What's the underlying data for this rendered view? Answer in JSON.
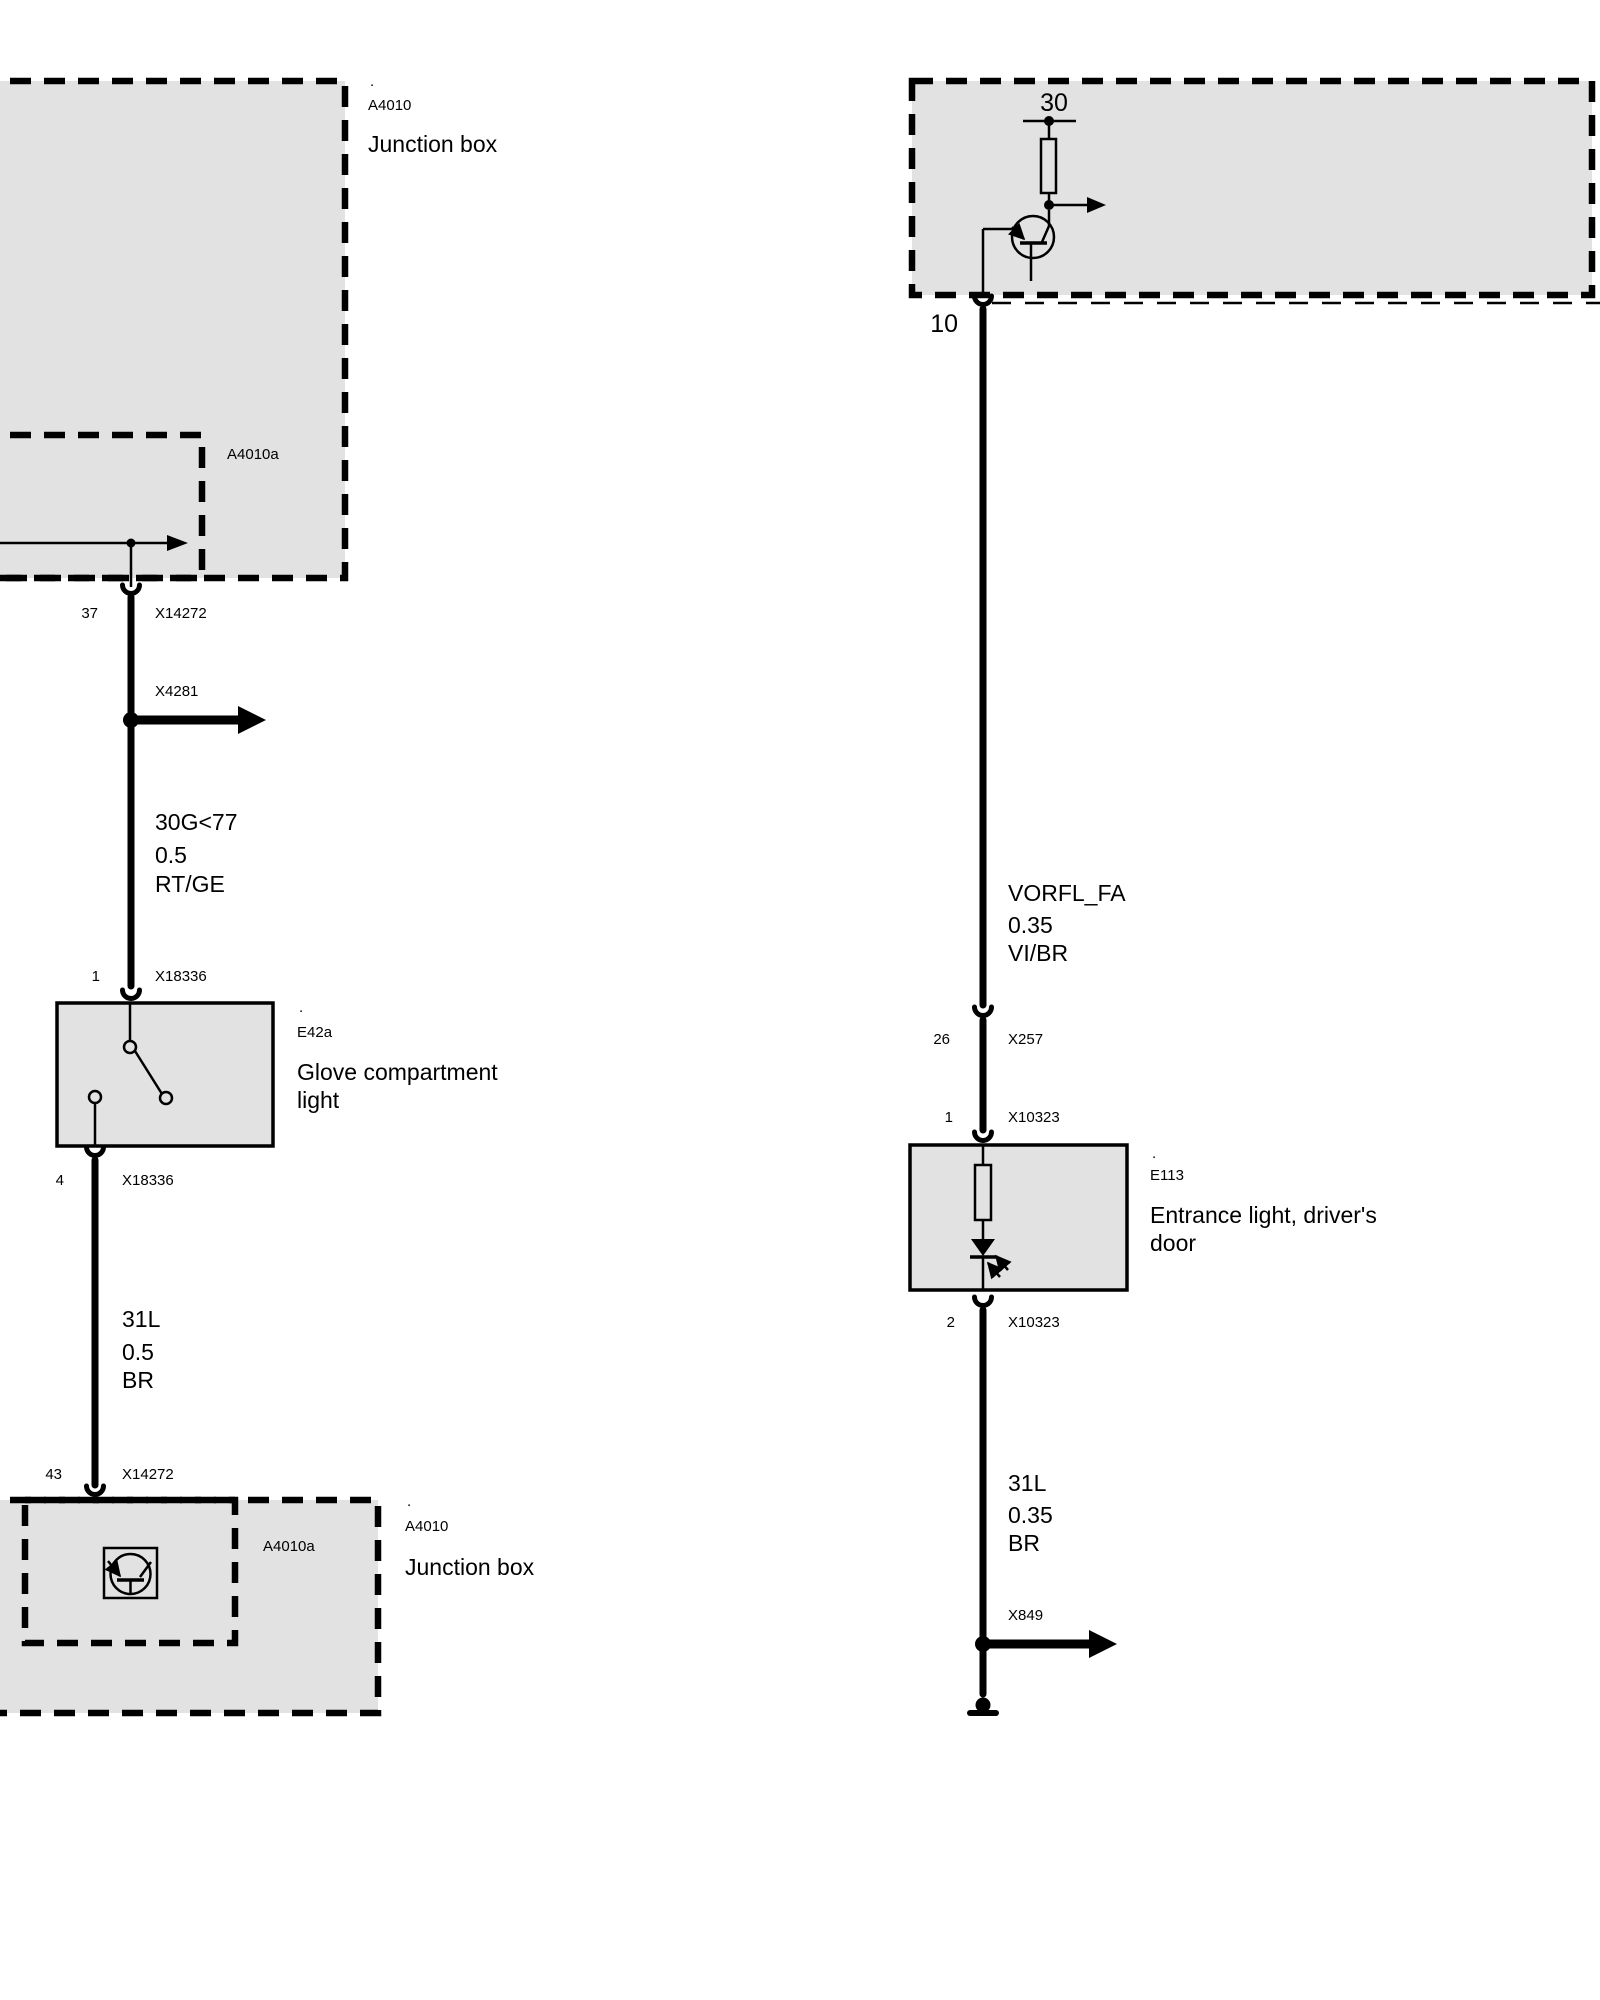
{
  "colors": {
    "bg": "#ffffff",
    "box_fill": "#e2e2e2",
    "line": "#000000"
  },
  "left": {
    "top_box": {
      "dot": ".",
      "id": "A4010",
      "name": "Junction box",
      "inner_id": "A4010a"
    },
    "conn37": {
      "pin": "37",
      "name": "X14272"
    },
    "splice": {
      "name": "X4281"
    },
    "wire_top": {
      "circuit": "30G<77",
      "size": "0.5",
      "color": "RT/GE"
    },
    "conn1": {
      "pin": "1",
      "name": "X18336"
    },
    "glove": {
      "dot": ".",
      "id": "E42a",
      "name1": "Glove compartment",
      "name2": "light"
    },
    "conn4": {
      "pin": "4",
      "name": "X18336"
    },
    "wire_bottom": {
      "circuit": "31L",
      "size": "0.5",
      "color": "BR"
    },
    "conn43": {
      "pin": "43",
      "name": "X14272"
    },
    "bottom_box": {
      "dot": ".",
      "id": "A4010",
      "name": "Junction box",
      "inner_id": "A4010a"
    }
  },
  "right": {
    "module": {
      "terminal": "30"
    },
    "conn10": {
      "pin": "10"
    },
    "wire_top": {
      "circuit": "VORFL_FA",
      "size": "0.35",
      "color": "VI/BR"
    },
    "conn26": {
      "pin": "26",
      "name": "X257"
    },
    "conn1": {
      "pin": "1",
      "name": "X10323"
    },
    "entrance": {
      "dot": ".",
      "id": "E113",
      "name1": "Entrance light, driver's",
      "name2": "door"
    },
    "conn2": {
      "pin": "2",
      "name": "X10323"
    },
    "wire_bottom": {
      "circuit": "31L",
      "size": "0.35",
      "color": "BR"
    },
    "splice": {
      "name": "X849"
    }
  }
}
